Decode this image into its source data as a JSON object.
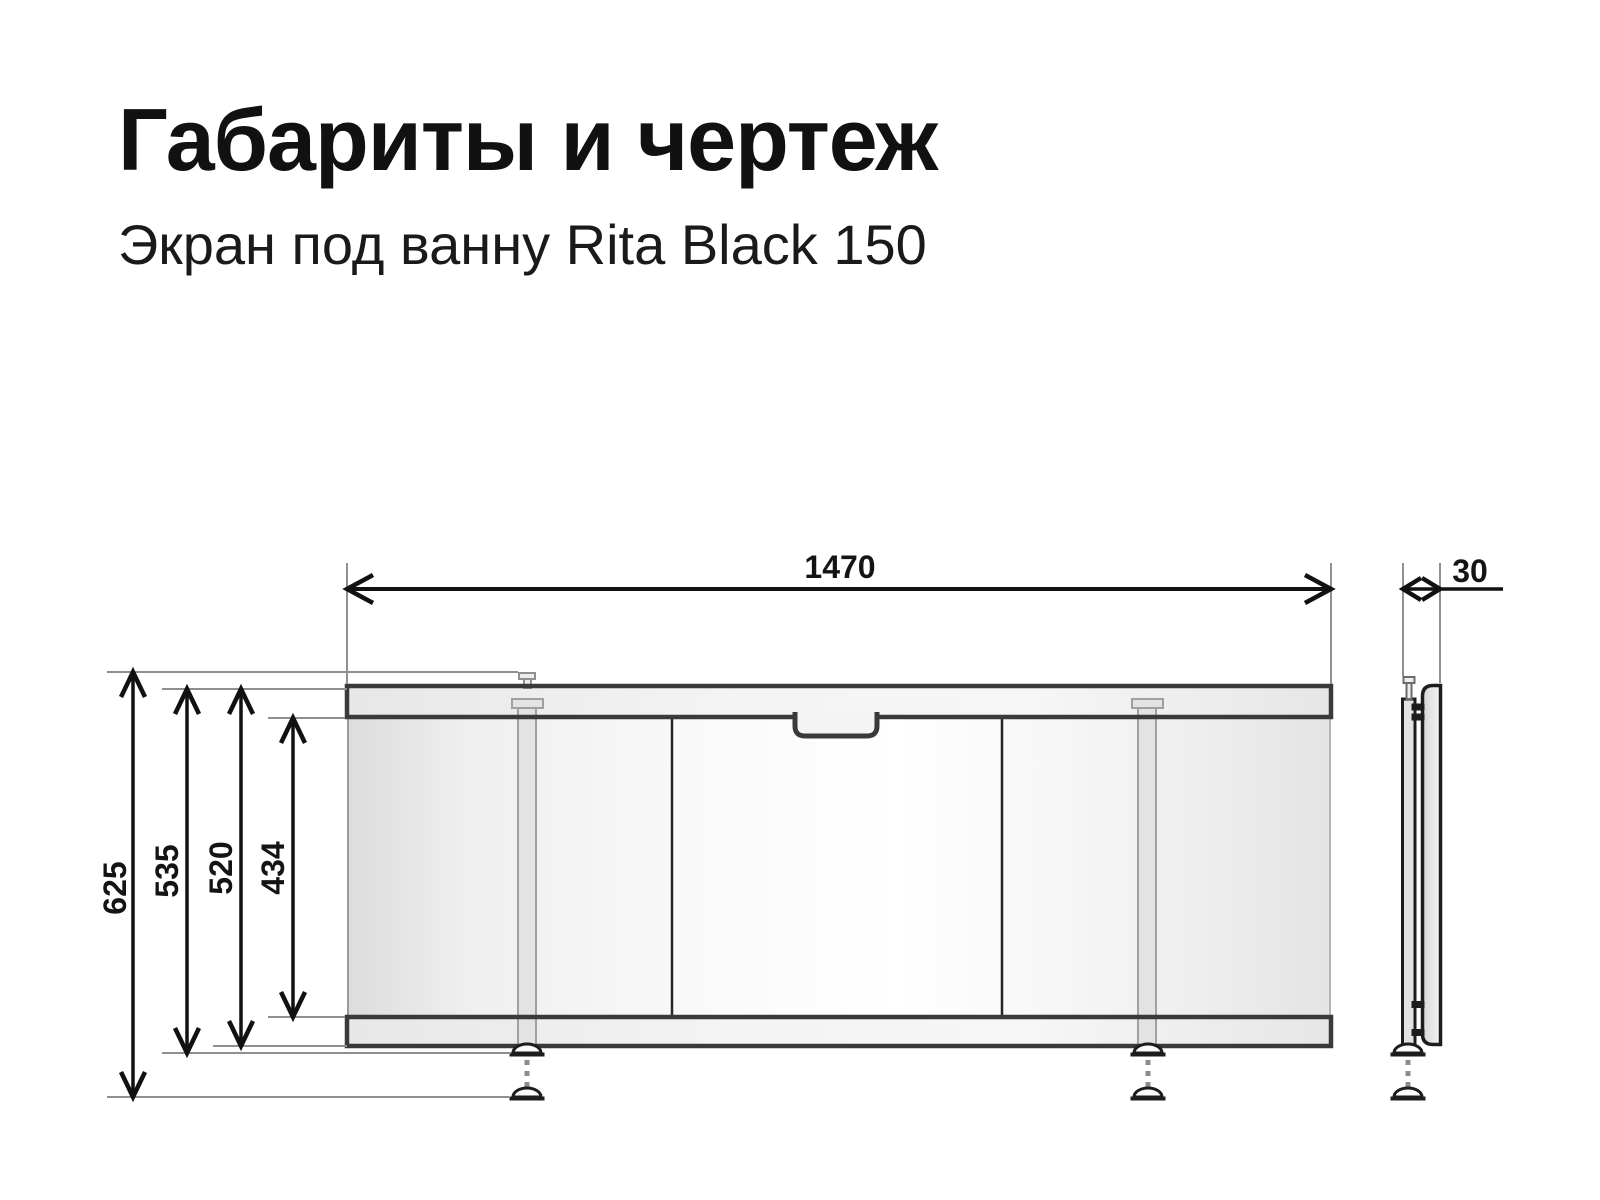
{
  "page": {
    "title": "Габариты и чертеж",
    "subtitle": "Экран под ванну Rita Black 150"
  },
  "drawing": {
    "product": "Экран под ванну Rita Black 150",
    "units": "mm",
    "width_mm": "1470",
    "depth_mm": "30",
    "height_overall_mm": "625",
    "height_to_foot_mm": "535",
    "height_screen_mm": "520",
    "height_panel_mm": "434"
  }
}
